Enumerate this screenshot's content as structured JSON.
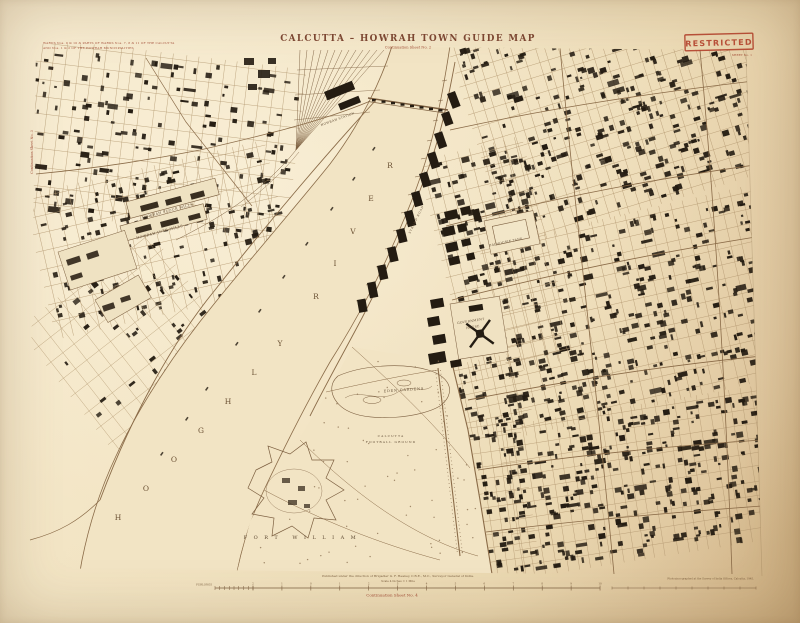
{
  "sheet": {
    "title": "CALCUTTA – HOWRAH TOWN GUIDE MAP",
    "subtitle": "Continuation Sheet No. 2",
    "stamp": "RESTRICTED",
    "sheet_note": "SHEET No. 1",
    "corner_note_line1": "WARDS Nos. 9 & 10 & PARTS OF WARDS Nos. 7, 8 & 11 OF THE CALCUTTA",
    "corner_note_line2": "AND Nos. 1 & 2 OF THE HOWRAH MUNICIPALITIES",
    "left_edge_note": "Continuation Sheet No. 3",
    "river_label": "HOOGHLY RIVER",
    "footer": {
      "imprint": "Published under the direction of Brigadier G. F. Heaney, C.B.E., M.C., Surveyor General of India.",
      "scale_caption": "Scale 4 Inches = 1 Mile",
      "scale_unit": "FURLONGS",
      "scale_ticks": [
        "2",
        "1",
        "0",
        "1",
        "2",
        "3",
        "4",
        "5",
        "6",
        "7",
        "8",
        "9",
        "10"
      ],
      "continuation": "Continuation Sheet No. 4",
      "print_note": "Photozincographed at the Survey of India Offices, Calcutta, 1945."
    },
    "labels": [
      {
        "text": "HOWRAH FLOUR MILLS",
        "x": 168,
        "y": 212,
        "r": -15,
        "s": 3.4,
        "ls": 0.5
      },
      {
        "text": "HOWRAH JUTE MILLS",
        "x": 160,
        "y": 233,
        "r": -15,
        "s": 3.4,
        "ls": 0.5
      },
      {
        "text": "HOWRAH STATION",
        "x": 338,
        "y": 120,
        "r": -20,
        "s": 3.0,
        "ls": 0.4
      },
      {
        "text": "DALHOUSIE TANK",
        "x": 506,
        "y": 243,
        "r": -12,
        "s": 3.1,
        "ls": 0.3
      },
      {
        "text": "GOVERNMENT",
        "x": 471,
        "y": 322,
        "r": -9,
        "s": 3.1,
        "ls": 0.3
      },
      {
        "text": "HOUSE",
        "x": 473,
        "y": 328,
        "r": -9,
        "s": 3.1,
        "ls": 0.3
      },
      {
        "text": "STRAND ROAD",
        "x": 417,
        "y": 220,
        "r": -64,
        "s": 2.8,
        "ls": 0.8
      },
      {
        "text": "EDEN GARDENS",
        "x": 404,
        "y": 391,
        "r": -4,
        "s": 3.5,
        "ls": 0.8
      },
      {
        "text": "CALCUTTA",
        "x": 391,
        "y": 437,
        "r": 0,
        "s": 3.1,
        "ls": 1.1
      },
      {
        "text": "FOOTBALL GROUND",
        "x": 391,
        "y": 443,
        "r": 0,
        "s": 3.1,
        "ls": 1.1
      },
      {
        "text": "FORT WILLIAM",
        "x": 303,
        "y": 539,
        "r": 0,
        "s": 5.0,
        "ls": 6.5
      }
    ]
  },
  "colors": {
    "paper": "#eedcbb",
    "river": "#f2e4c4",
    "ink": "#7c5f40",
    "light_ink": "#b39871",
    "road": "#8a6b48",
    "building": "#241c12",
    "tree": "#8f7455",
    "red": "#b0452c",
    "title": "#7d4733",
    "label": "#5f4a33",
    "river_text": "#6b5134"
  }
}
